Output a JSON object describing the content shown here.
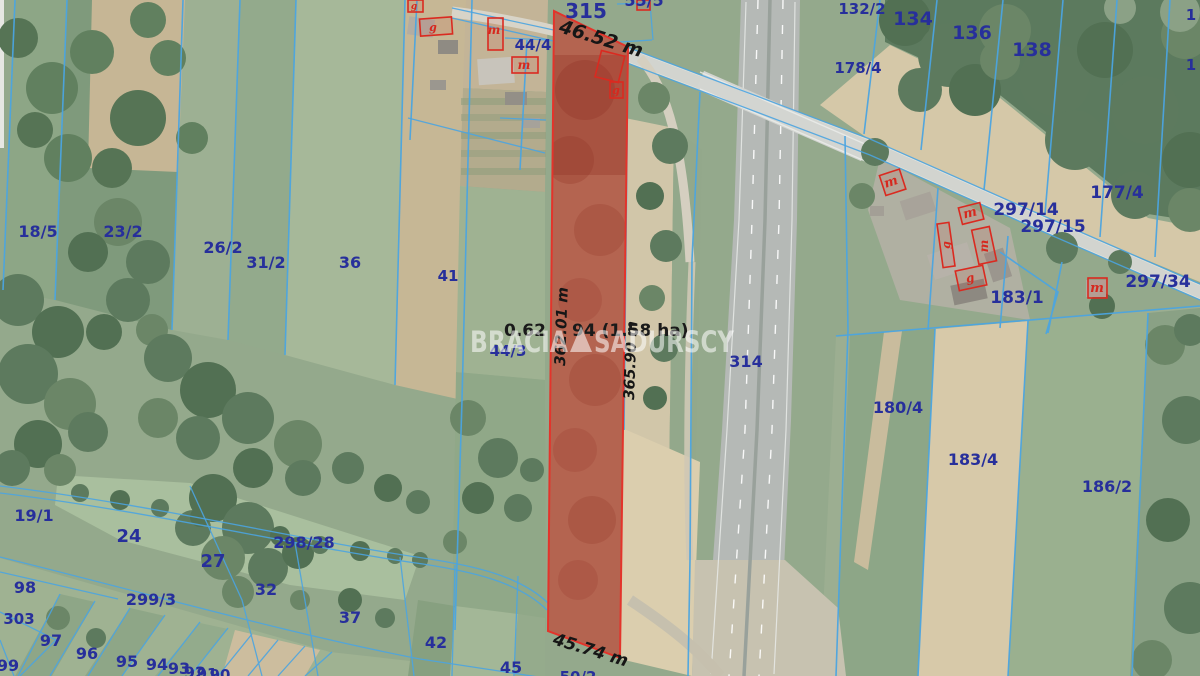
{
  "map": {
    "watermark": {
      "brand_left": "BRACIA",
      "brand_right": "SADURSCY",
      "logo": "triangle-icon"
    },
    "highlighted_parcel": {
      "dimension_top": "46.52 m",
      "dimension_bottom": "45.74 m",
      "dimension_left": "362.01 m",
      "dimension_right": "365.90 m",
      "area_fragment_left": "0.62",
      "area_fragment_right": "94 (1.58 ha)",
      "outline_color": "#e3342b"
    },
    "parcel_labels": {
      "n315": "315",
      "n55_5": "55/5",
      "n132_2": "132/2",
      "n134": "134",
      "n136": "136",
      "n138": "138",
      "n178_4": "178/4",
      "n177_4": "177/4",
      "n297_14": "297/14",
      "n297_15": "297/15",
      "n297_34": "297/34",
      "n183_1": "183/1",
      "n44_4": "44/4",
      "n44_3": "44/3",
      "n18_5": "18/5",
      "n23_2": "23/2",
      "n26_2": "26/2",
      "n31_2": "31/2",
      "n36": "36",
      "n41": "41",
      "n314": "314",
      "n180_4": "180/4",
      "n183_4": "183/4",
      "n186_2": "186/2",
      "n19_1": "19/1",
      "n24": "24",
      "n27": "27",
      "n298_28": "298/28",
      "n32": "32",
      "n37": "37",
      "n98": "98",
      "n303": "303",
      "n299_3": "299/3",
      "n97": "97",
      "n96": "96",
      "n95": "95",
      "n94": "94",
      "n93": "93",
      "n92": "92",
      "n91": "91",
      "n90": "90",
      "n99": "99",
      "n42": "42",
      "n45": "45",
      "n50_2": "50/2",
      "n1a": "1",
      "n1b": "1"
    },
    "building_marks": {
      "residential": "m",
      "outbuilding": "g"
    },
    "colors": {
      "boundary_blue": "#4ba4e0",
      "label_navy": "#272f9b",
      "highlight_red": "#e3342b",
      "building_red": "#d6281e",
      "dimension_black": "#161616",
      "watermark_white": "#ffffff"
    }
  }
}
